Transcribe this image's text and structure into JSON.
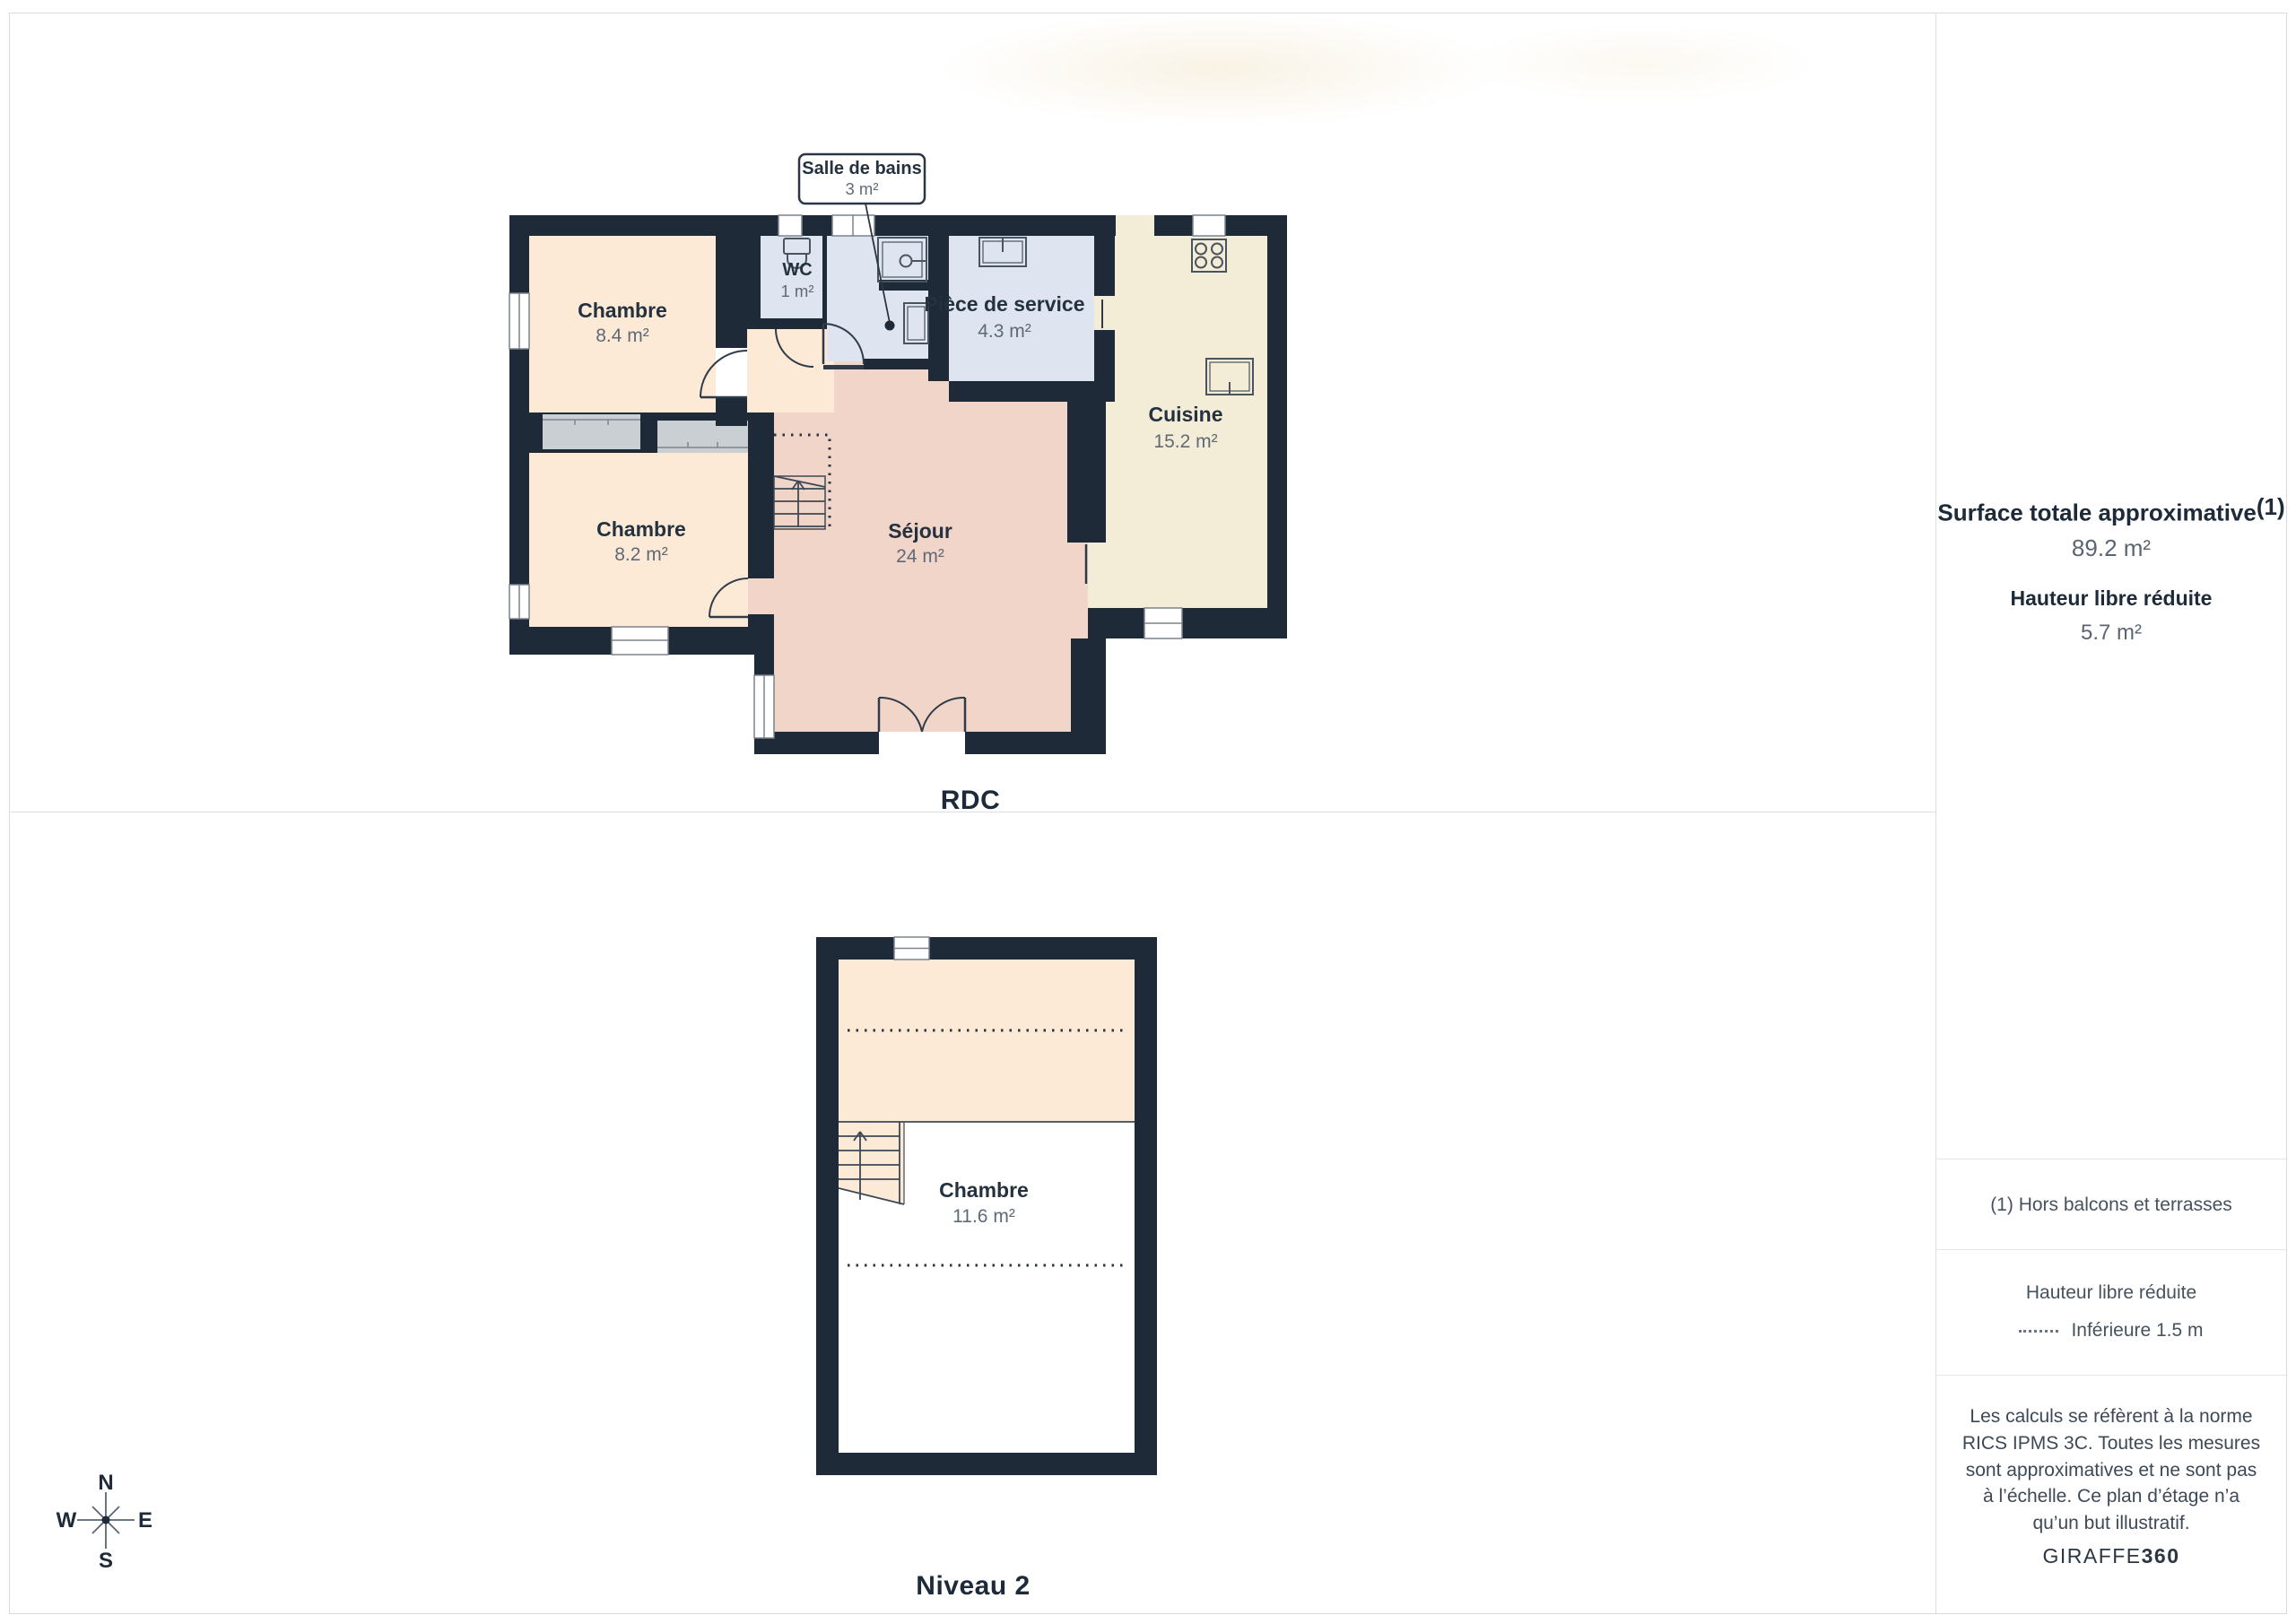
{
  "floors": {
    "rdc": {
      "label": "RDC",
      "rooms": {
        "chambre1": {
          "name": "Chambre",
          "area": "8.4 m²"
        },
        "chambre2": {
          "name": "Chambre",
          "area": "8.2 m²"
        },
        "wc": {
          "name": "WC",
          "area": "1 m²"
        },
        "salle_de_bains": {
          "name": "Salle de bains",
          "area": "3 m²"
        },
        "piece_de_service": {
          "name": "Pièce de service",
          "area": "4.3 m²"
        },
        "sejour": {
          "name": "Séjour",
          "area": "24 m²"
        },
        "cuisine": {
          "name": "Cuisine",
          "area": "15.2 m²"
        }
      }
    },
    "niveau2": {
      "label": "Niveau 2",
      "rooms": {
        "chambre": {
          "name": "Chambre",
          "area": "11.6 m²"
        }
      }
    }
  },
  "sidebar": {
    "surface_title": "Surface totale approximative",
    "surface_title_sup": "(1)",
    "surface_value": "89.2 m²",
    "hauteur_title": "Hauteur libre réduite",
    "hauteur_value": "5.7 m²",
    "footnote": "(1) Hors balcons et terrasses",
    "legend_title": "Hauteur libre réduite",
    "legend_item": "Inférieure 1.5 m",
    "disclaimer": "Les calculs se réfèrent à la norme RICS IPMS 3C. Toutes les mesures sont approximatives et ne sont pas à l’échelle. Ce plan d’étage n’a qu’un but illustratif.",
    "brand_name": "GIRAFFE",
    "brand_suffix": "360"
  },
  "compass": {
    "n": "N",
    "s": "S",
    "e": "E",
    "w": "W"
  },
  "colors": {
    "wall": "#1f2a38",
    "bedroom_fill": "#fcead7",
    "living_fill": "#f1d5c9",
    "kitchen_fill": "#f3ecd6",
    "wet_room_fill": "#dee4f0",
    "closet_fill": "#cacfd4",
    "label_dark": "#1c2a3a",
    "label_gray": "#5f6a76"
  }
}
